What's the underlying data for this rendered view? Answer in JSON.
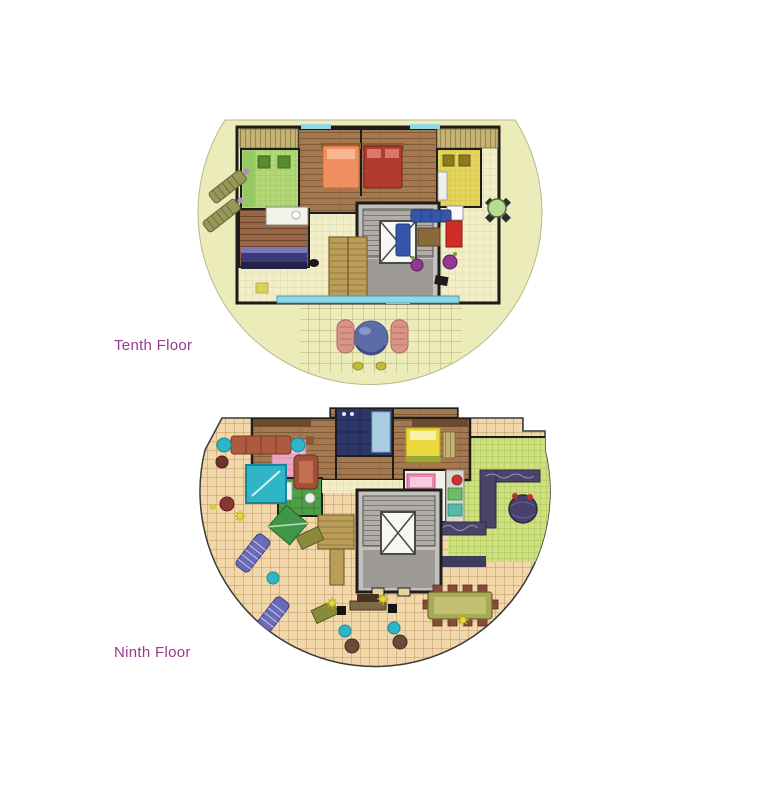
{
  "page": {
    "page-bg": "#ffffff"
  },
  "palette": {
    "page-bg": "#ffffff",
    "label-color": "#993a8c",
    "plan1-bg": "#ecebba",
    "plan2-bg": "#f1d7a9",
    "wall": "#1d1d1b",
    "pool": "#8fd8e8",
    "wood": "#a5784e",
    "cream-tile": "#f2efc8",
    "green-living": "#cfe080",
    "core-gray": "#c4c1bc",
    "accent-teal": "#2fb6c6"
  },
  "plans": [
    {
      "name": "tenth-floor",
      "label": "Tenth Floor"
    },
    {
      "name": "ninth-floor",
      "label": "Ninth Floor"
    }
  ]
}
